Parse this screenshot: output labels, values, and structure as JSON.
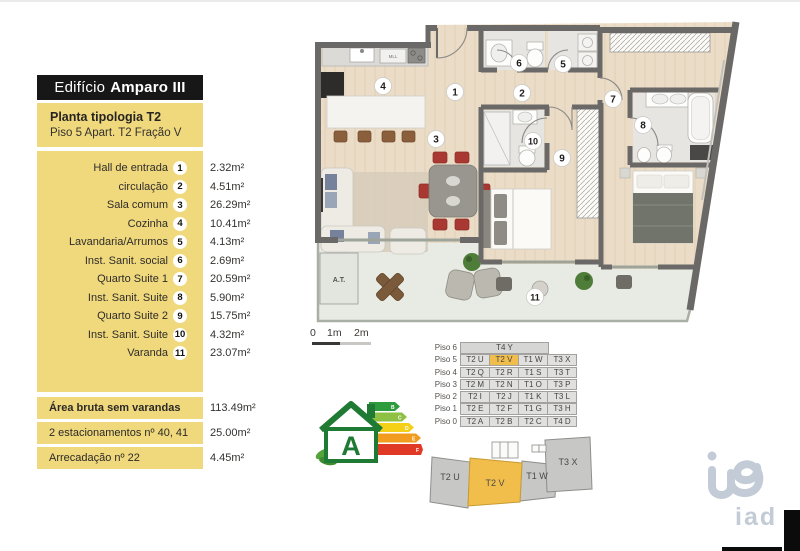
{
  "header": {
    "title_regular": "Edifício",
    "title_bold": "Amparo III"
  },
  "subtitle": {
    "line1": "Planta tipologia T2",
    "line2": "Piso 5 Apart. T2 Fração V"
  },
  "sidebar": {
    "rooms": [
      {
        "num": "1",
        "label": "Hall de entrada",
        "area": "2.32m²"
      },
      {
        "num": "2",
        "label": "circulação",
        "area": "4.51m²"
      },
      {
        "num": "3",
        "label": "Sala comum",
        "area": "26.29m²"
      },
      {
        "num": "4",
        "label": "Cozinha",
        "area": "10.41m²"
      },
      {
        "num": "5",
        "label": "Lavandaria/Arrumos",
        "area": "4.13m²"
      },
      {
        "num": "6",
        "label": "Inst. Sanit. social",
        "area": "2.69m²"
      },
      {
        "num": "7",
        "label": "Quarto Suite 1",
        "area": "20.59m²"
      },
      {
        "num": "8",
        "label": "Inst. Sanit. Suite",
        "area": "5.90m²"
      },
      {
        "num": "9",
        "label": "Quarto Suite 2",
        "area": "15.75m²"
      },
      {
        "num": "10",
        "label": "Inst. Sanit. Suite",
        "area": "4.32m²"
      },
      {
        "num": "11",
        "label": "Varanda",
        "area": "23.07m²"
      }
    ],
    "summary": [
      {
        "label": "Área bruta sem varandas",
        "area": "113.49m²"
      },
      {
        "label": "2 estacionamentos nº 40, 41",
        "area": "25.00m²"
      },
      {
        "label": "Arrecadação nº 22",
        "area": "4.45m²"
      }
    ]
  },
  "plan": {
    "markers": [
      "1",
      "2",
      "3",
      "4",
      "5",
      "6",
      "7",
      "8",
      "9",
      "10",
      "11"
    ],
    "at_label": "A.T.",
    "kitchen_unit_label": "MLL"
  },
  "scale": {
    "labels": [
      "0",
      "1m",
      "2m"
    ]
  },
  "floors_table": {
    "rows": [
      {
        "label": "Piso 6",
        "cells": [
          "T4 Y"
        ]
      },
      {
        "label": "Piso 5",
        "cells": [
          "T2 U",
          "T2 V",
          "T1 W",
          "T3 X"
        ]
      },
      {
        "label": "Piso 4",
        "cells": [
          "T2 Q",
          "T2 R",
          "T1 S",
          "T3 T"
        ]
      },
      {
        "label": "Piso 3",
        "cells": [
          "T2 M",
          "T2 N",
          "T1 O",
          "T3 P"
        ]
      },
      {
        "label": "Piso 2",
        "cells": [
          "T2 I",
          "T2 J",
          "T1 K",
          "T3 L"
        ]
      },
      {
        "label": "Piso 1",
        "cells": [
          "T2 E",
          "T2 F",
          "T1 G",
          "T3 H"
        ]
      },
      {
        "label": "Piso 0",
        "cells": [
          "T2 A",
          "T2 B",
          "T2 C",
          "T4 D"
        ]
      }
    ],
    "highlighted_unit": "T2 V"
  },
  "outline": {
    "units": [
      "T2 U",
      "T2 V",
      "T1 W",
      "T3 X"
    ],
    "highlighted_unit": "T2 V"
  },
  "energy_label": {
    "letter": "A",
    "bar_letters": [
      "B",
      "C",
      "D",
      "E",
      "F"
    ]
  },
  "brand": {
    "name": "iad"
  },
  "colors": {
    "panel_yellow": "#F0D87C",
    "highlight_orange": "#F1BE4B",
    "wall_gray": "#6B6967",
    "wood_floor": "#EADCC6",
    "balcony_floor": "#E8EBE3",
    "bath_floor": "#E7E5E1",
    "chair_red": "#A93832",
    "energy_green": "#1F7A34",
    "brand_gray": "#C3CBD7"
  }
}
